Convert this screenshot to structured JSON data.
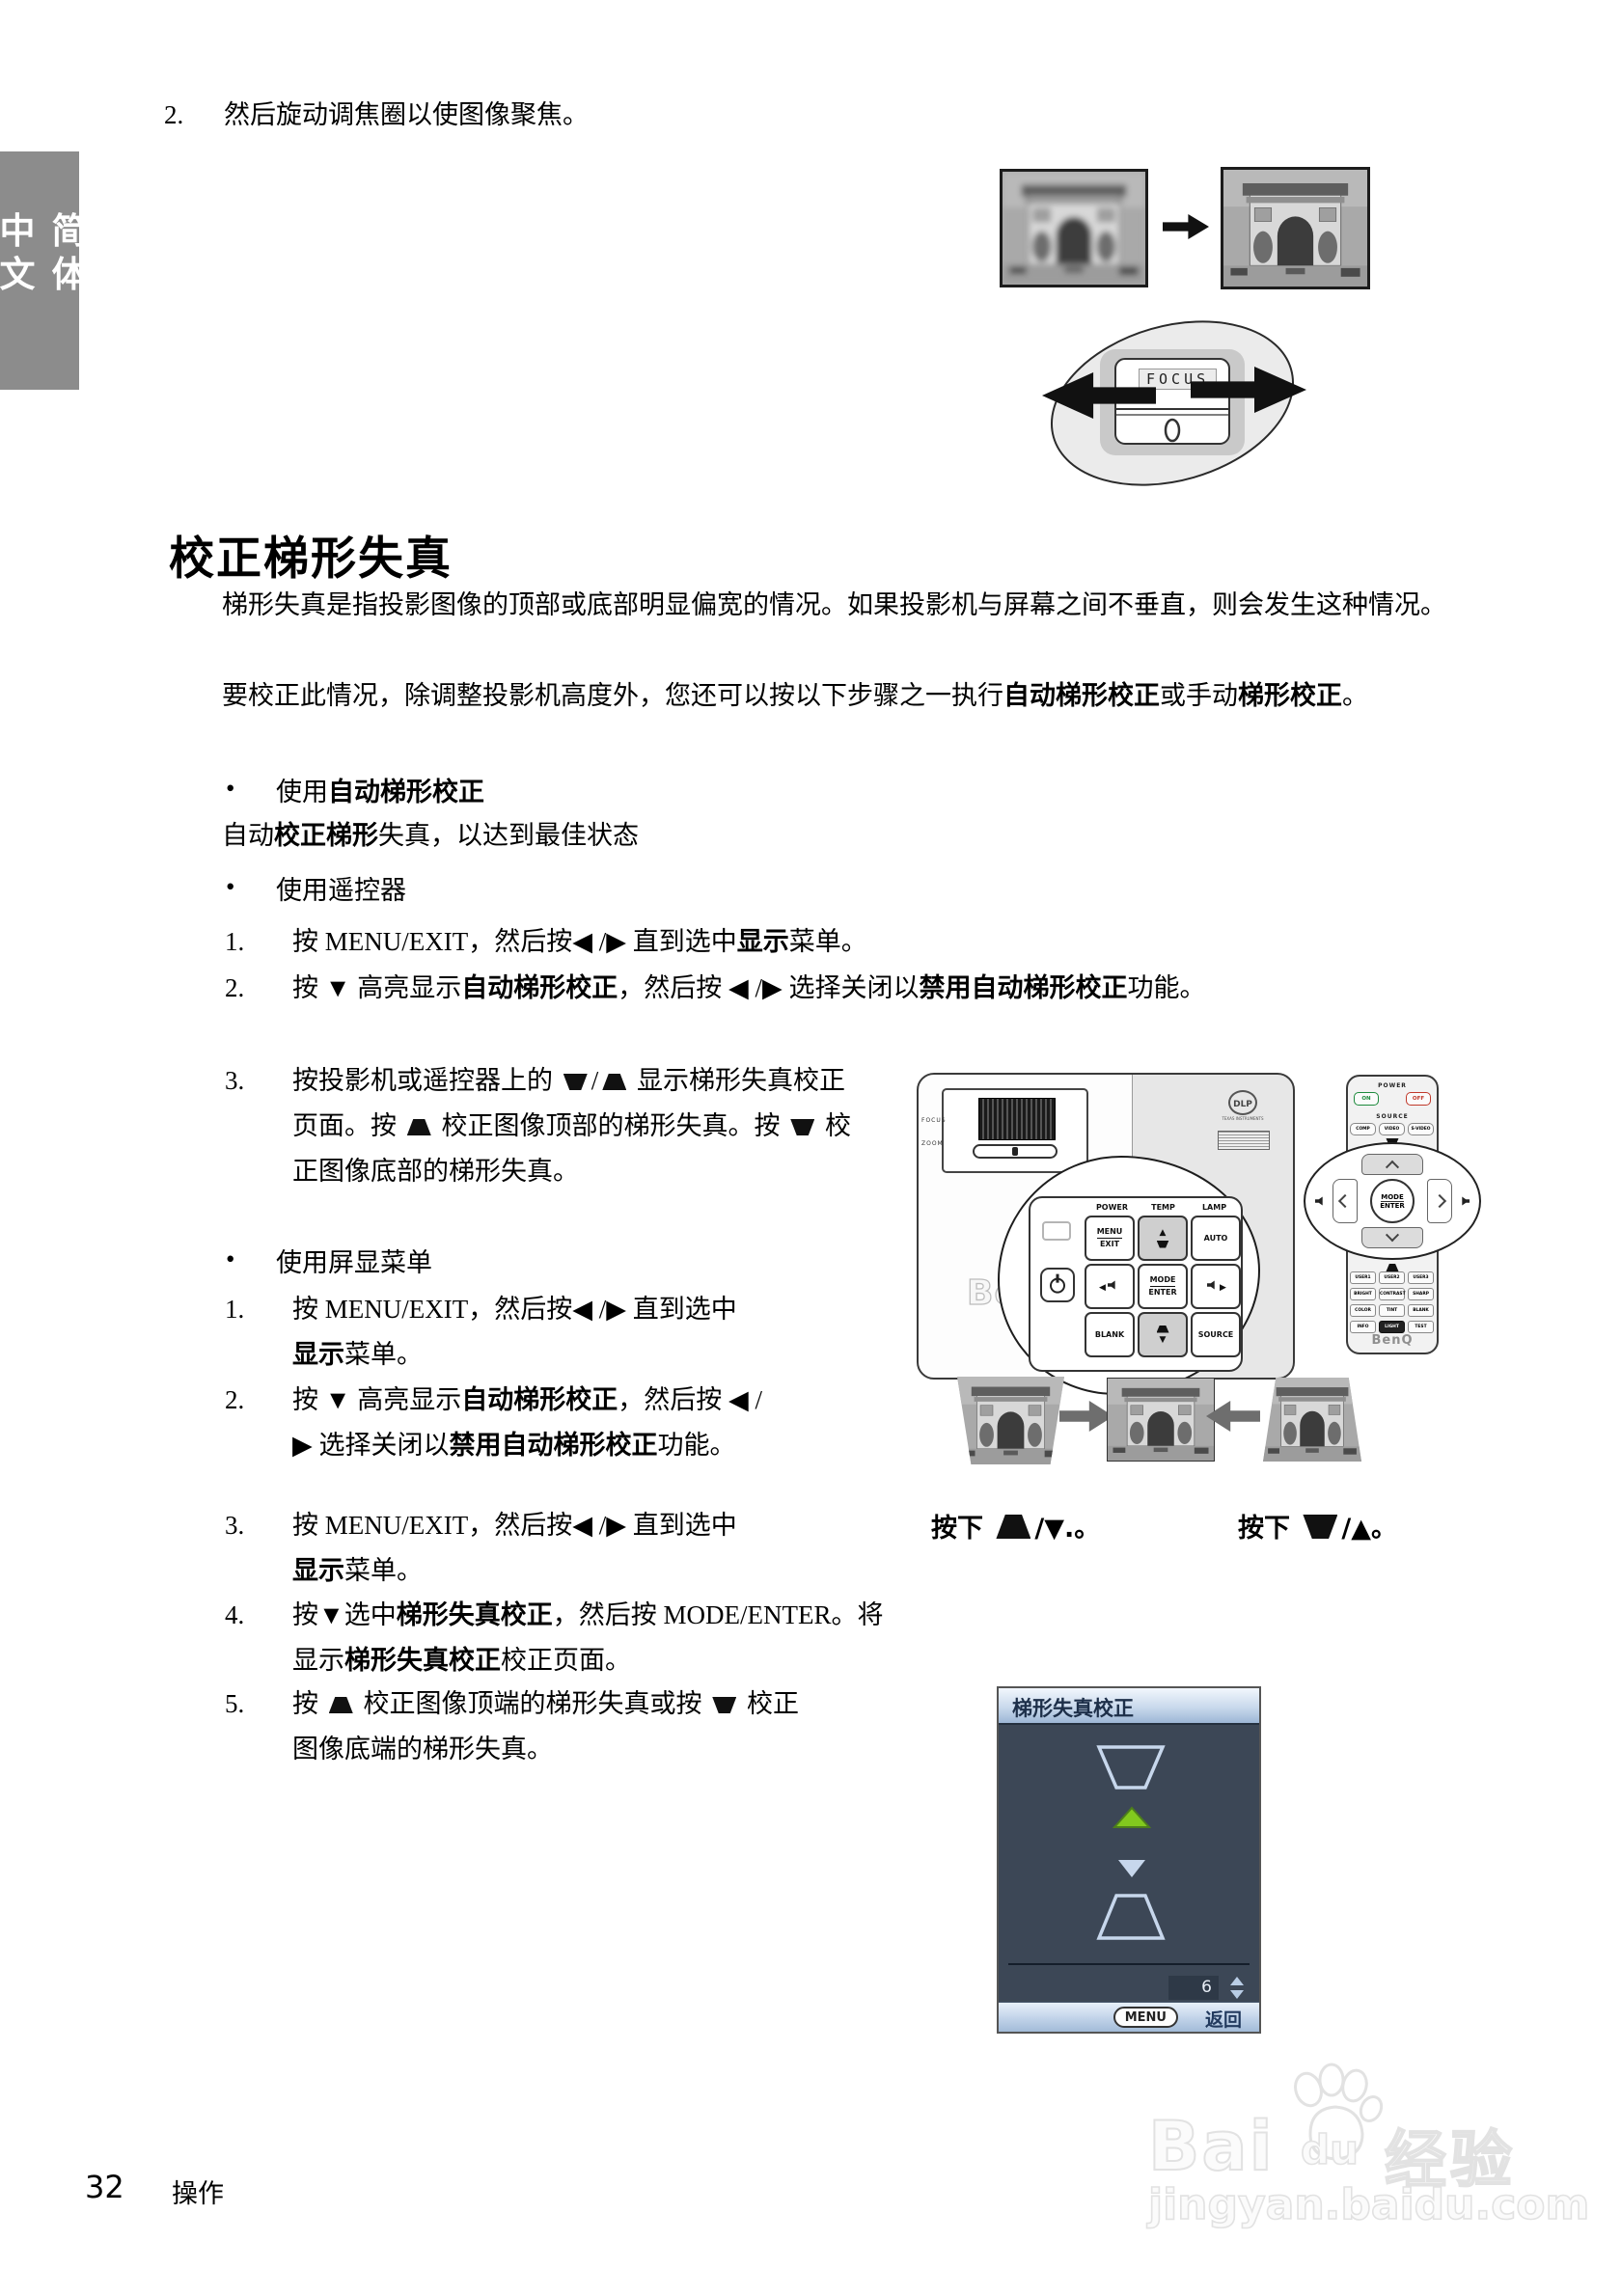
{
  "sidebar": {
    "label": "简体中文"
  },
  "step2": {
    "n": "2.",
    "text": "然后旋动调焦圈以使图像聚焦。"
  },
  "focus_fig": {
    "label": "FOCUS"
  },
  "heading": {
    "title": "校正梯形失真"
  },
  "intro": {
    "p1": [
      {
        "t": "梯形失真是指投影图像的顶部或底部明显偏宽的情况。如果投影机与屏幕之间不垂直，则会发生这种情况。"
      }
    ],
    "p2": [
      {
        "t": "要校正此情况，除调整投影机高度外，您还可以按以下步骤之一执行"
      },
      {
        "t": "自动梯形校正",
        "b": 1
      },
      {
        "t": "或手动"
      },
      {
        "t": "梯形校正",
        "b": 1
      },
      {
        "t": "。"
      }
    ]
  },
  "bullets": {
    "auto_title": [
      {
        "t": "使用"
      },
      {
        "t": "自动梯形校正",
        "b": 1
      }
    ],
    "auto_line": [
      {
        "t": "自动"
      },
      {
        "t": "校正梯形",
        "b": 1
      },
      {
        "t": "失真，以达到最佳状态"
      }
    ],
    "remote_title": [
      {
        "t": "使用遥控器"
      }
    ],
    "osd_title": [
      {
        "t": "使用屏显菜单"
      }
    ]
  },
  "list_remote": {
    "items": [
      {
        "n": "1.",
        "segments": [
          {
            "t": "按 MENU/EXIT，然后按◀ /▶ 直到选中"
          },
          {
            "t": "显示",
            "b": 1
          },
          {
            "t": "菜单。"
          }
        ]
      },
      {
        "n": "2.",
        "segments": [
          {
            "t": "按 ▼ 高亮显示"
          },
          {
            "t": "自动梯形校正",
            "b": 1
          },
          {
            "t": "，然后按 ◀ /▶ 选择关闭以"
          },
          {
            "t": "禁用自动梯形校正",
            "b": 1
          },
          {
            "t": "功能。"
          }
        ]
      },
      {
        "n": "3.",
        "segments": [
          {
            "t": "按投影机或遥控器上的 "
          },
          {
            "i": "keystone-down"
          },
          {
            "t": "/"
          },
          {
            "i": "keystone-up"
          },
          {
            "t": " 显示梯形失真校正页面。按 "
          },
          {
            "i": "keystone-up"
          },
          {
            "t": " 校正图像顶部的梯形失真。按 "
          },
          {
            "i": "keystone-down"
          },
          {
            "t": " 校正图像底部的梯形失真。"
          }
        ]
      }
    ]
  },
  "list_osd": {
    "items": [
      {
        "n": "1.",
        "segments": [
          {
            "t": "按 MENU/EXIT，然后按◀ /▶ 直到选中"
          },
          {
            "t": "显示",
            "b": 1
          },
          {
            "t": "菜单。"
          }
        ]
      },
      {
        "n": "2.",
        "segments": [
          {
            "t": "按 ▼ 高亮显示"
          },
          {
            "t": "自动梯形校正",
            "b": 1
          },
          {
            "t": "，然后按 ◀ /▶ 选择关闭以"
          },
          {
            "t": "禁用自动梯形校正",
            "b": 1
          },
          {
            "t": "功能。"
          }
        ]
      },
      {
        "n": "3.",
        "segments": [
          {
            "t": "按 MENU/EXIT，然后按◀ /▶ 直到选中"
          },
          {
            "t": "显示",
            "b": 1
          },
          {
            "t": "菜单。"
          }
        ]
      },
      {
        "n": "4.",
        "segments": [
          {
            "t": "按▼选中"
          },
          {
            "t": "梯形失真校正",
            "b": 1
          },
          {
            "t": "，然后按 MODE/ENTER。将显示"
          },
          {
            "t": "梯形失真校正",
            "b": 1
          },
          {
            "t": "校正页面。"
          }
        ]
      },
      {
        "n": "5.",
        "segments": [
          {
            "t": "按 "
          },
          {
            "i": "keystone-up"
          },
          {
            "t": " 校正图像顶端的梯形失真或按 "
          },
          {
            "i": "keystone-down"
          },
          {
            "t": " 校正图像底端的梯形失真。"
          }
        ]
      }
    ]
  },
  "captions": {
    "left": [
      {
        "t": "按下 "
      },
      {
        "i": "keystone-up",
        "s": "big"
      },
      {
        "t": "/▼.。"
      }
    ],
    "right": [
      {
        "t": "按下 "
      },
      {
        "i": "keystone-down",
        "s": "big"
      },
      {
        "t": "/▲。"
      }
    ]
  },
  "projector": {
    "headers": [
      "POWER",
      "TEMP",
      "LAMP"
    ],
    "key_menu_1": "MENU",
    "key_menu_2": "EXIT",
    "key_auto": "AUTO",
    "key_mode_1": "MODE",
    "key_mode_2": "ENTER",
    "key_blank": "BLANK",
    "key_source": "SOURCE",
    "tri_up": "▲",
    "tri_down": "▼",
    "tri_left": "◀",
    "tri_right": "▶",
    "lens_focus": "FOCUS",
    "lens_zoom": "ZOOM",
    "dlp": "DLP",
    "dlp_sub": "TEXAS INSTRUMENTS",
    "brand": "BenQ"
  },
  "remote": {
    "power": "POWER",
    "on": "ON",
    "off": "OFF",
    "source": "SOURCE",
    "comp": "COMP",
    "video": "VIDEO",
    "svideo": "S-VIDEO",
    "mode": "MODE",
    "enter": "ENTER",
    "rows": [
      [
        "USER1",
        "USER2",
        "USER3"
      ],
      [
        "BRIGHT",
        "CONTRAST",
        "SHARP"
      ],
      [
        "COLOR",
        "TINT",
        "BLANK"
      ],
      [
        "INFO",
        "LIGHT",
        "TEST"
      ]
    ],
    "brand": "BenQ"
  },
  "osd": {
    "title": "梯形失真校正",
    "value": "6",
    "menu": "MENU",
    "back": "返回"
  },
  "footer": {
    "page": "32",
    "section": "操作"
  },
  "watermark": {
    "bai": "Bai",
    "du": "du",
    "cn": "经验",
    "url": "jingyan.baidu.com"
  },
  "colors": {
    "accent_green": "#82c91e",
    "osd_body": "#3c4756",
    "osd_header": "#c9d9ec",
    "tab_gray": "#8c8c8c"
  }
}
